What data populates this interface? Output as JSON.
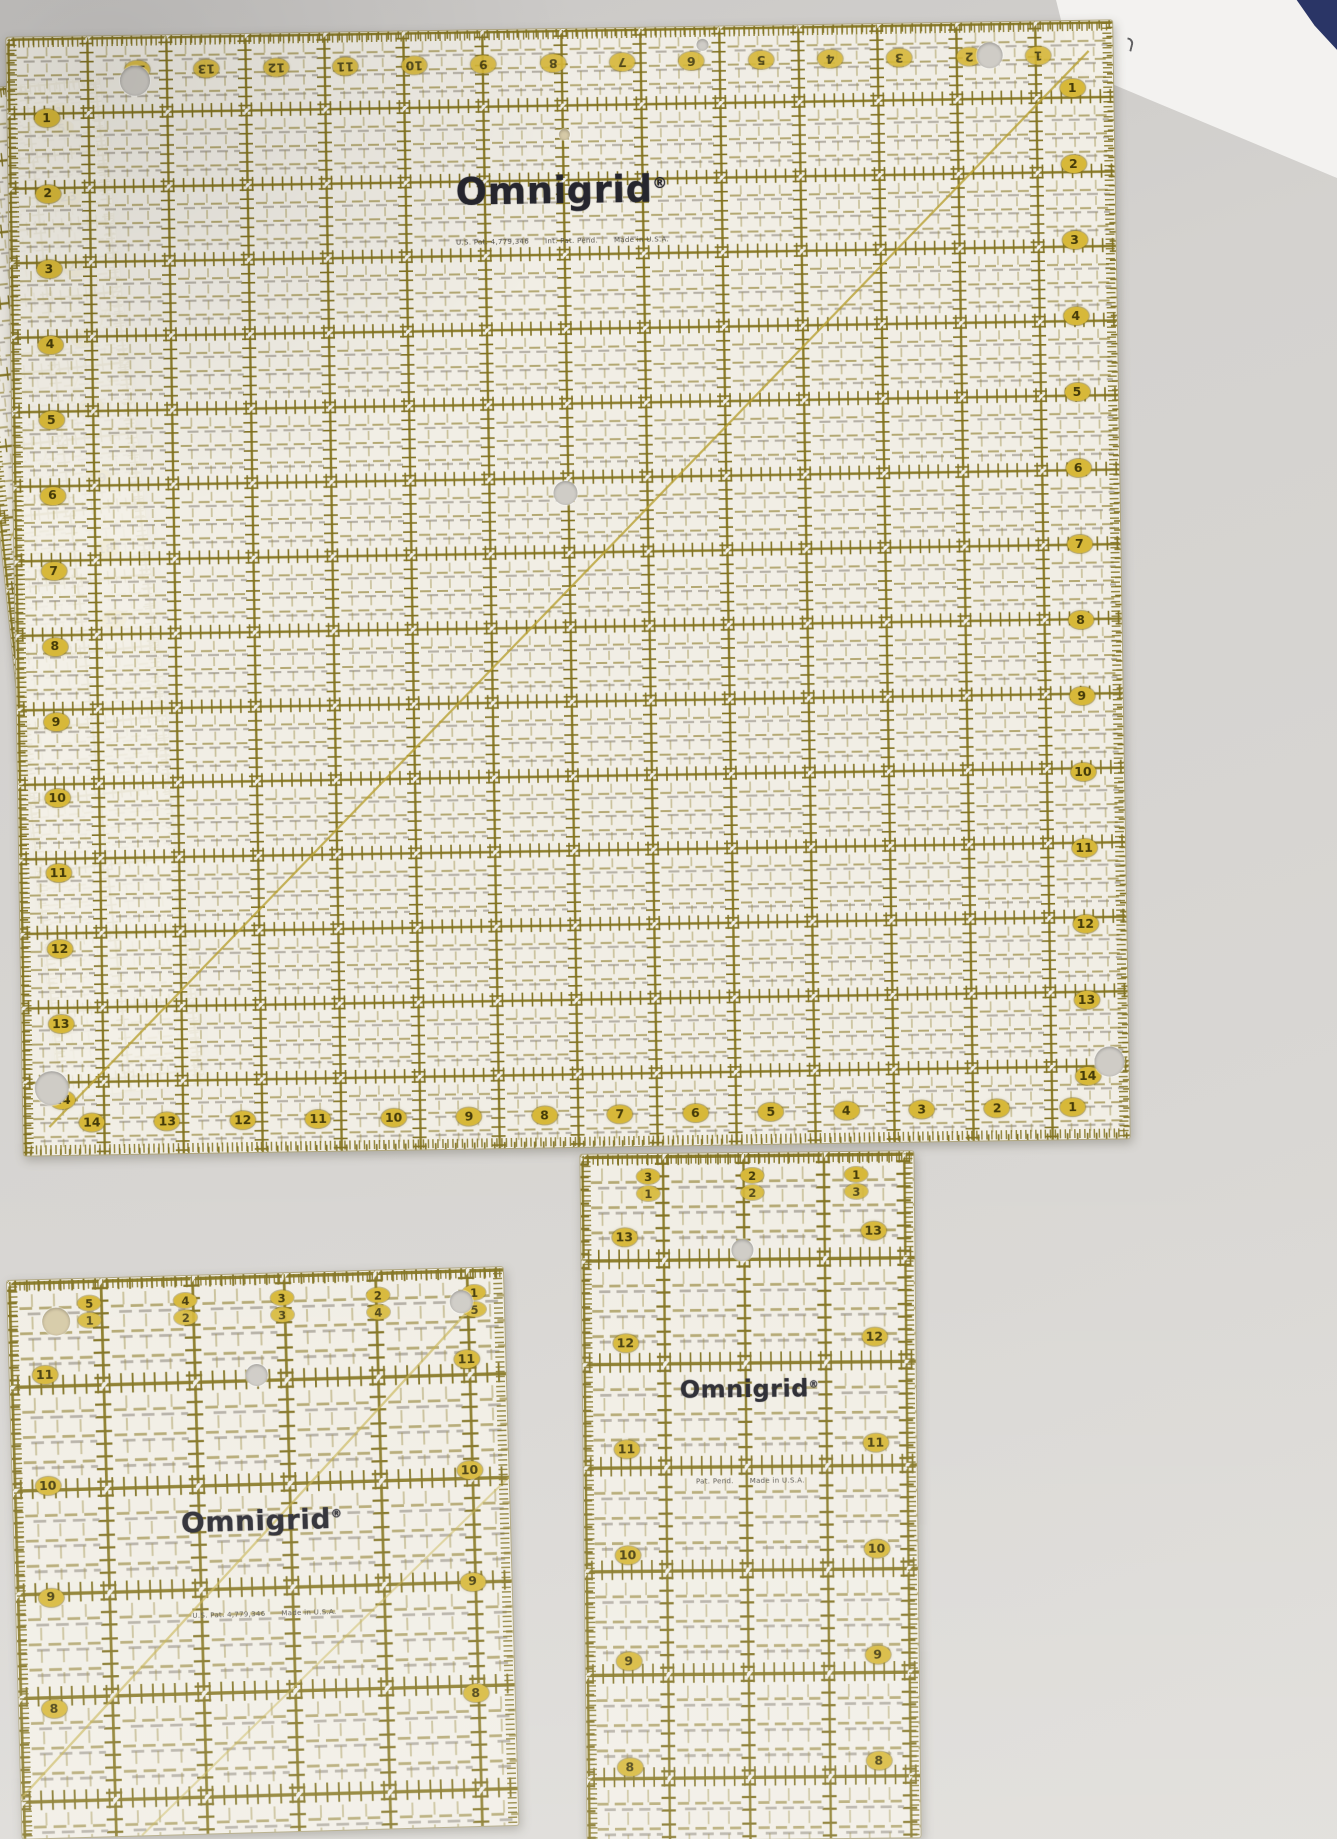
{
  "colors": {
    "table": "#d4d2cf",
    "ruler_body": "#f3f0e6",
    "grid_olive": "#8c7c26",
    "badge_gold": "#d9b832",
    "badge_text": "#453b07",
    "logo_ink": "#26262e",
    "paper_white": "#f3f2f0",
    "paper_navy": "#2a3566"
  },
  "left_ruler": {
    "fraction": [
      "1",
      "5"
    ],
    "numbers": [
      "23",
      "22",
      "21",
      "20",
      "19",
      "18",
      "17"
    ]
  },
  "big_ruler": {
    "brand": "Omnigrid",
    "reg": "®",
    "fine_print": [
      "U.S. Pat. 4,779,346",
      "Int. Pat. Pend.",
      "Made in U.S.A."
    ],
    "top_numbers": [
      "14",
      "13",
      "12",
      "11",
      "10",
      "9",
      "8",
      "7",
      "6",
      "5",
      "4",
      "3",
      "2",
      "1"
    ],
    "bottom_numbers": [
      "14",
      "13",
      "12",
      "11",
      "10",
      "9",
      "8",
      "7",
      "6",
      "5",
      "4",
      "3",
      "2",
      "1"
    ],
    "left_numbers": [
      "1",
      "2",
      "3",
      "4",
      "5",
      "6",
      "7",
      "8",
      "9",
      "10",
      "11",
      "12",
      "13",
      "14"
    ],
    "right_numbers": [
      "1",
      "2",
      "3",
      "4",
      "5",
      "6",
      "7",
      "8",
      "9",
      "10",
      "11",
      "12",
      "13",
      "14"
    ]
  },
  "square_ruler": {
    "brand": "Omnigrid",
    "reg": "®",
    "header_fractions": [
      [
        "5",
        "1"
      ],
      [
        "4",
        "2"
      ],
      [
        "3",
        "3"
      ],
      [
        "2",
        "4"
      ],
      [
        "1",
        "5"
      ]
    ],
    "left_numbers": [
      "11",
      "10",
      "9",
      "8"
    ],
    "right_numbers": [
      "11",
      "10",
      "9",
      "8"
    ],
    "fine_print": [
      "U.S. Pat. 4,779,346",
      "Made in U.S.A."
    ]
  },
  "tall_ruler": {
    "brand": "Omnigrid",
    "reg": "®",
    "header_fractions": [
      [
        "3",
        "1"
      ],
      [
        "2",
        "2"
      ],
      [
        "1",
        "3"
      ]
    ],
    "left_numbers": [
      "13",
      "12",
      "11",
      "10",
      "9",
      "8"
    ],
    "right_numbers": [
      "13",
      "12",
      "11",
      "10",
      "9",
      "8"
    ],
    "fine_print": [
      "Pat. Pend.",
      "Made in U.S.A."
    ]
  }
}
